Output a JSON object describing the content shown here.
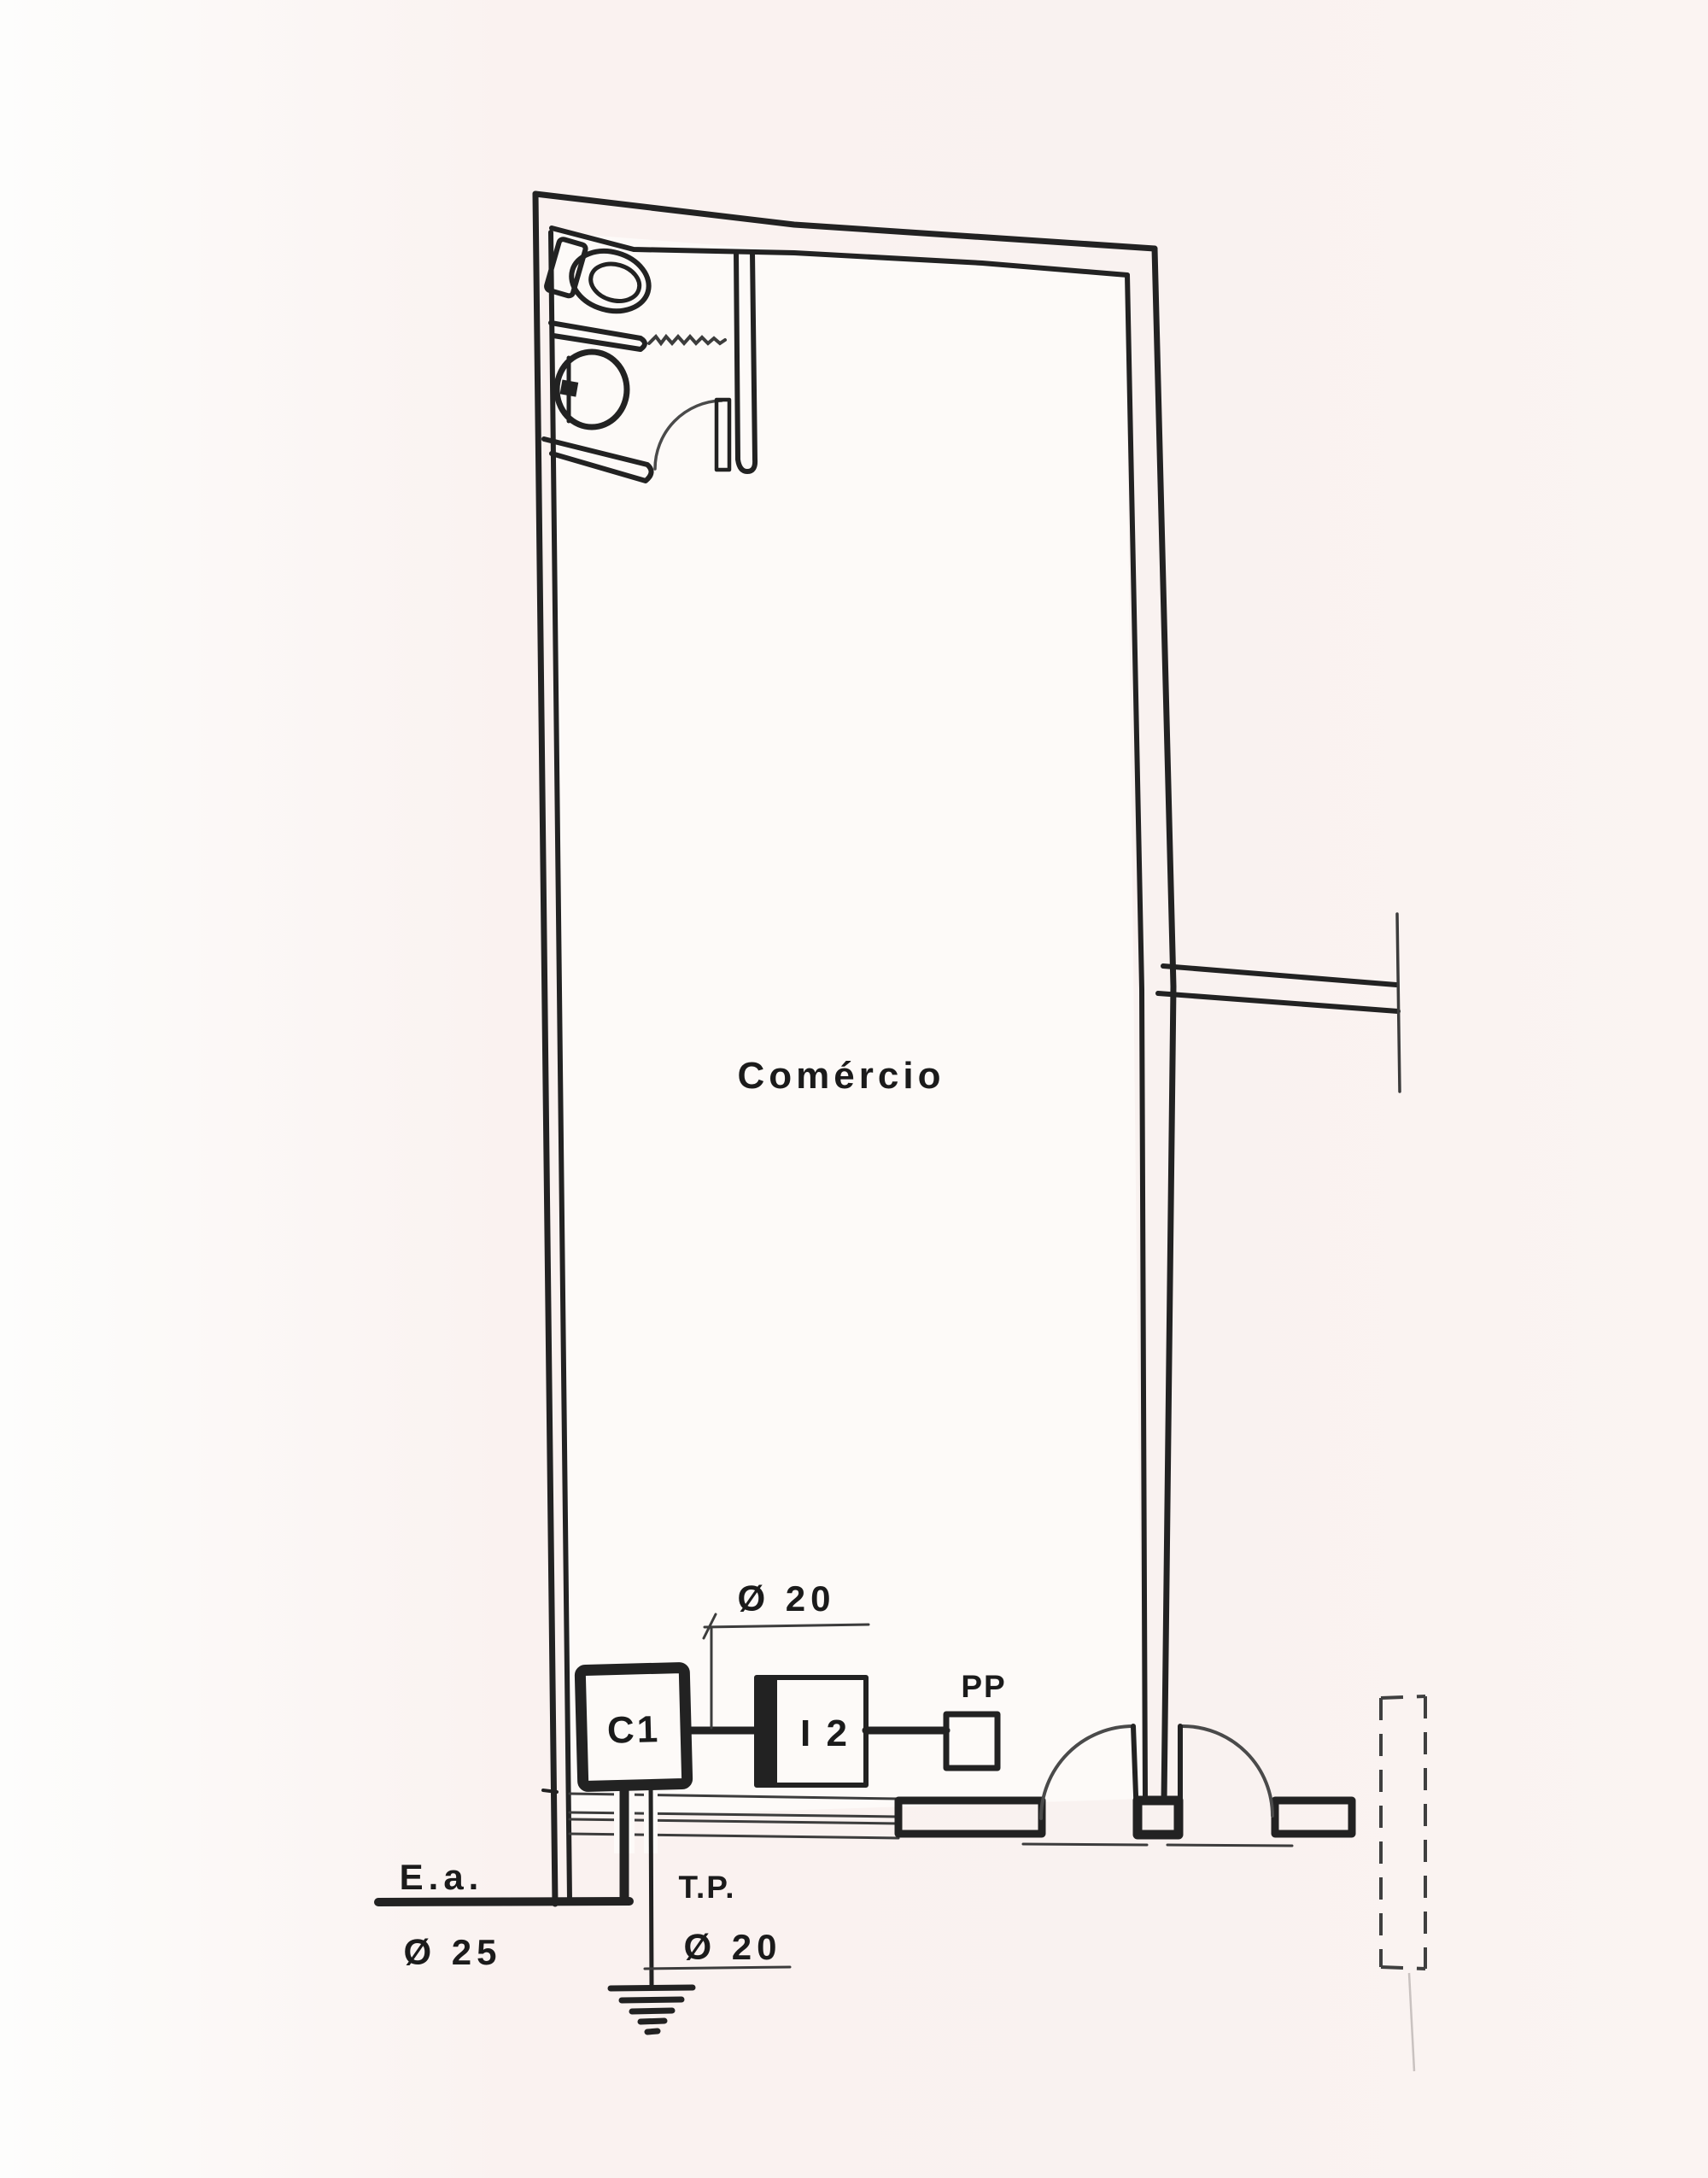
{
  "drawing": {
    "type": "floor-plan-electrical-diagram",
    "room_label": "Comércio",
    "devices": {
      "c1": "C1",
      "i2": "I 2",
      "pp": "PP"
    },
    "labels": {
      "dim_top": "Ø 20",
      "ea": "E.a.",
      "ea_dim": "Ø 25",
      "tp": "T.P.",
      "tp_dim": "Ø 20"
    },
    "colors": {
      "line": "#222222",
      "thin_line": "#3c3c3c",
      "background": "#f9f2f0",
      "paper": "#fdfaf8"
    }
  }
}
